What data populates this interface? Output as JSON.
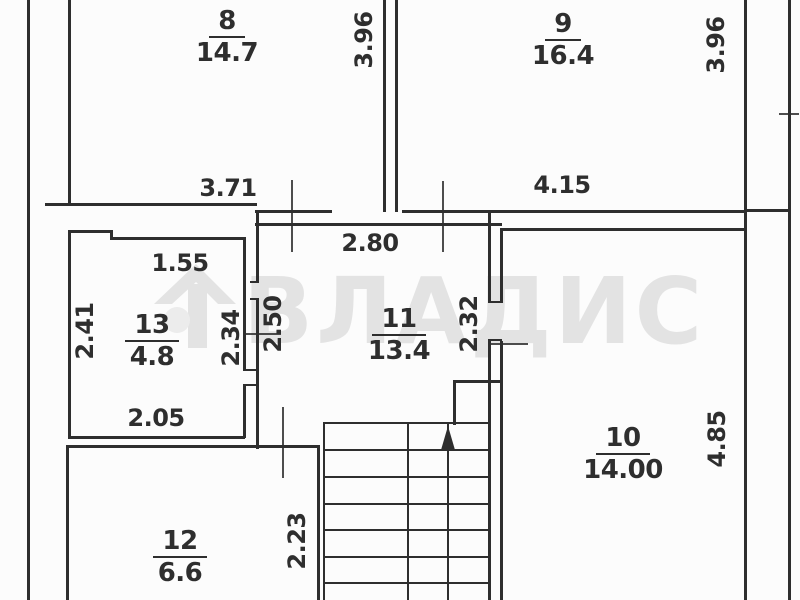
{
  "plan": {
    "watermark": "ВЛАДИС",
    "colors": {
      "line": "#2e2e2e",
      "watermark": "#e3e3e3",
      "background": "#fcfcfc"
    },
    "rooms": {
      "r8": {
        "number": "8",
        "area": "14.7"
      },
      "r9": {
        "number": "9",
        "area": "16.4"
      },
      "r10": {
        "number": "10",
        "area": "14.00"
      },
      "r11": {
        "number": "11",
        "area": "13.4"
      },
      "r12": {
        "number": "12",
        "area": "6.6"
      },
      "r13": {
        "number": "13",
        "area": "4.8"
      }
    },
    "dims": {
      "room8_height": "3.96",
      "room9_height": "3.96",
      "room8_width": "3.71",
      "room9_width": "4.15",
      "room11_width": "2.80",
      "room13_top_width": "1.55",
      "room13_height": "2.41",
      "room13_right_height": "2.34",
      "room11_left_height": "2.50",
      "room11_right_height": "2.32",
      "room10_height": "4.85",
      "room13_bottom_width": "2.05",
      "stair_hall_height": "2.23"
    }
  }
}
